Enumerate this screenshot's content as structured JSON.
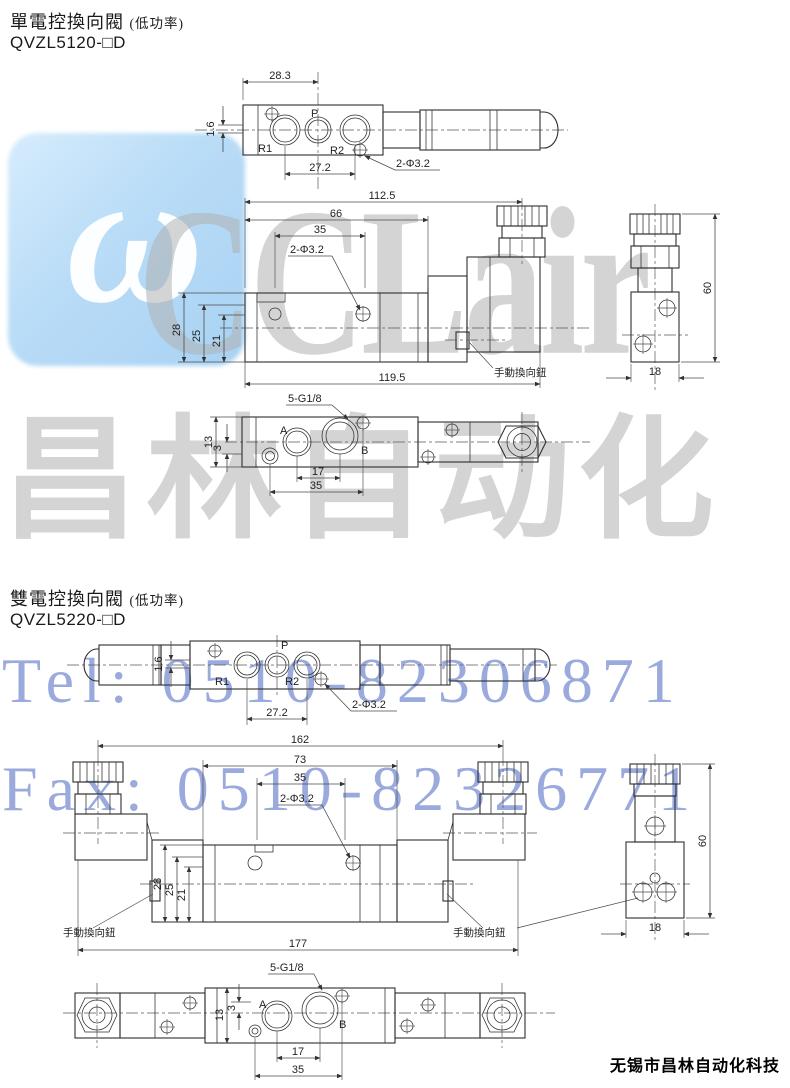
{
  "watermark": {
    "logo_glyph": "ω",
    "brand_latin": "CCLair",
    "brand_cn": "昌林自动化",
    "tel": "Tel: 0510-82306871",
    "fax": "Fax: 0510-82326771",
    "colors": {
      "logo_bg": "#b9dcf7",
      "gray_text": "#b7b7b7",
      "blue_text": "#899bd6"
    }
  },
  "footer": {
    "company": "无锡市昌林自动化科技"
  },
  "sections": [
    {
      "title": "單電控換向閥",
      "note": "(低功率)",
      "model": "QVZL5120-□D",
      "top": {
        "d_28_3": "28.3",
        "d_1_6": "1.6",
        "d_27_2": "27.2",
        "hole": "2-Φ3.2",
        "r1": "R1",
        "p": "P",
        "r2": "R2"
      },
      "front": {
        "d_112_5": "112.5",
        "d_66": "66",
        "d_35": "35",
        "hole": "2-Φ3.2",
        "d_28": "28",
        "d_25": "25",
        "d_21": "21",
        "d_119_5": "119.5",
        "manual": "手動換向鈕"
      },
      "side": {
        "d_60": "60",
        "d_18": "18"
      },
      "bottom": {
        "thread": "5-G1/8",
        "a": "A",
        "b": "B",
        "d_13": "13",
        "d_3": "3",
        "d_17": "17",
        "d_35": "35"
      }
    },
    {
      "title": "雙電控換向閥",
      "note": "(低功率)",
      "model": "QVZL5220-□D",
      "top": {
        "d_1_6": "1.6",
        "d_27_2": "27.2",
        "hole": "2-Φ3.2",
        "r1": "R1",
        "p": "P",
        "r2": "R2"
      },
      "front": {
        "d_162": "162",
        "d_73": "73",
        "d_35": "35",
        "hole": "2-Φ3.2",
        "d_28": "28",
        "d_25": "25",
        "d_21": "21",
        "d_177": "177",
        "manual_left": "手動換向鈕",
        "manual_right": "手動換向鈕"
      },
      "side": {
        "d_60": "60",
        "d_18": "18"
      },
      "bottom": {
        "thread": "5-G1/8",
        "a": "A",
        "b": "B",
        "d_13": "13",
        "d_3": "3",
        "d_17": "17",
        "d_35": "35"
      }
    }
  ]
}
